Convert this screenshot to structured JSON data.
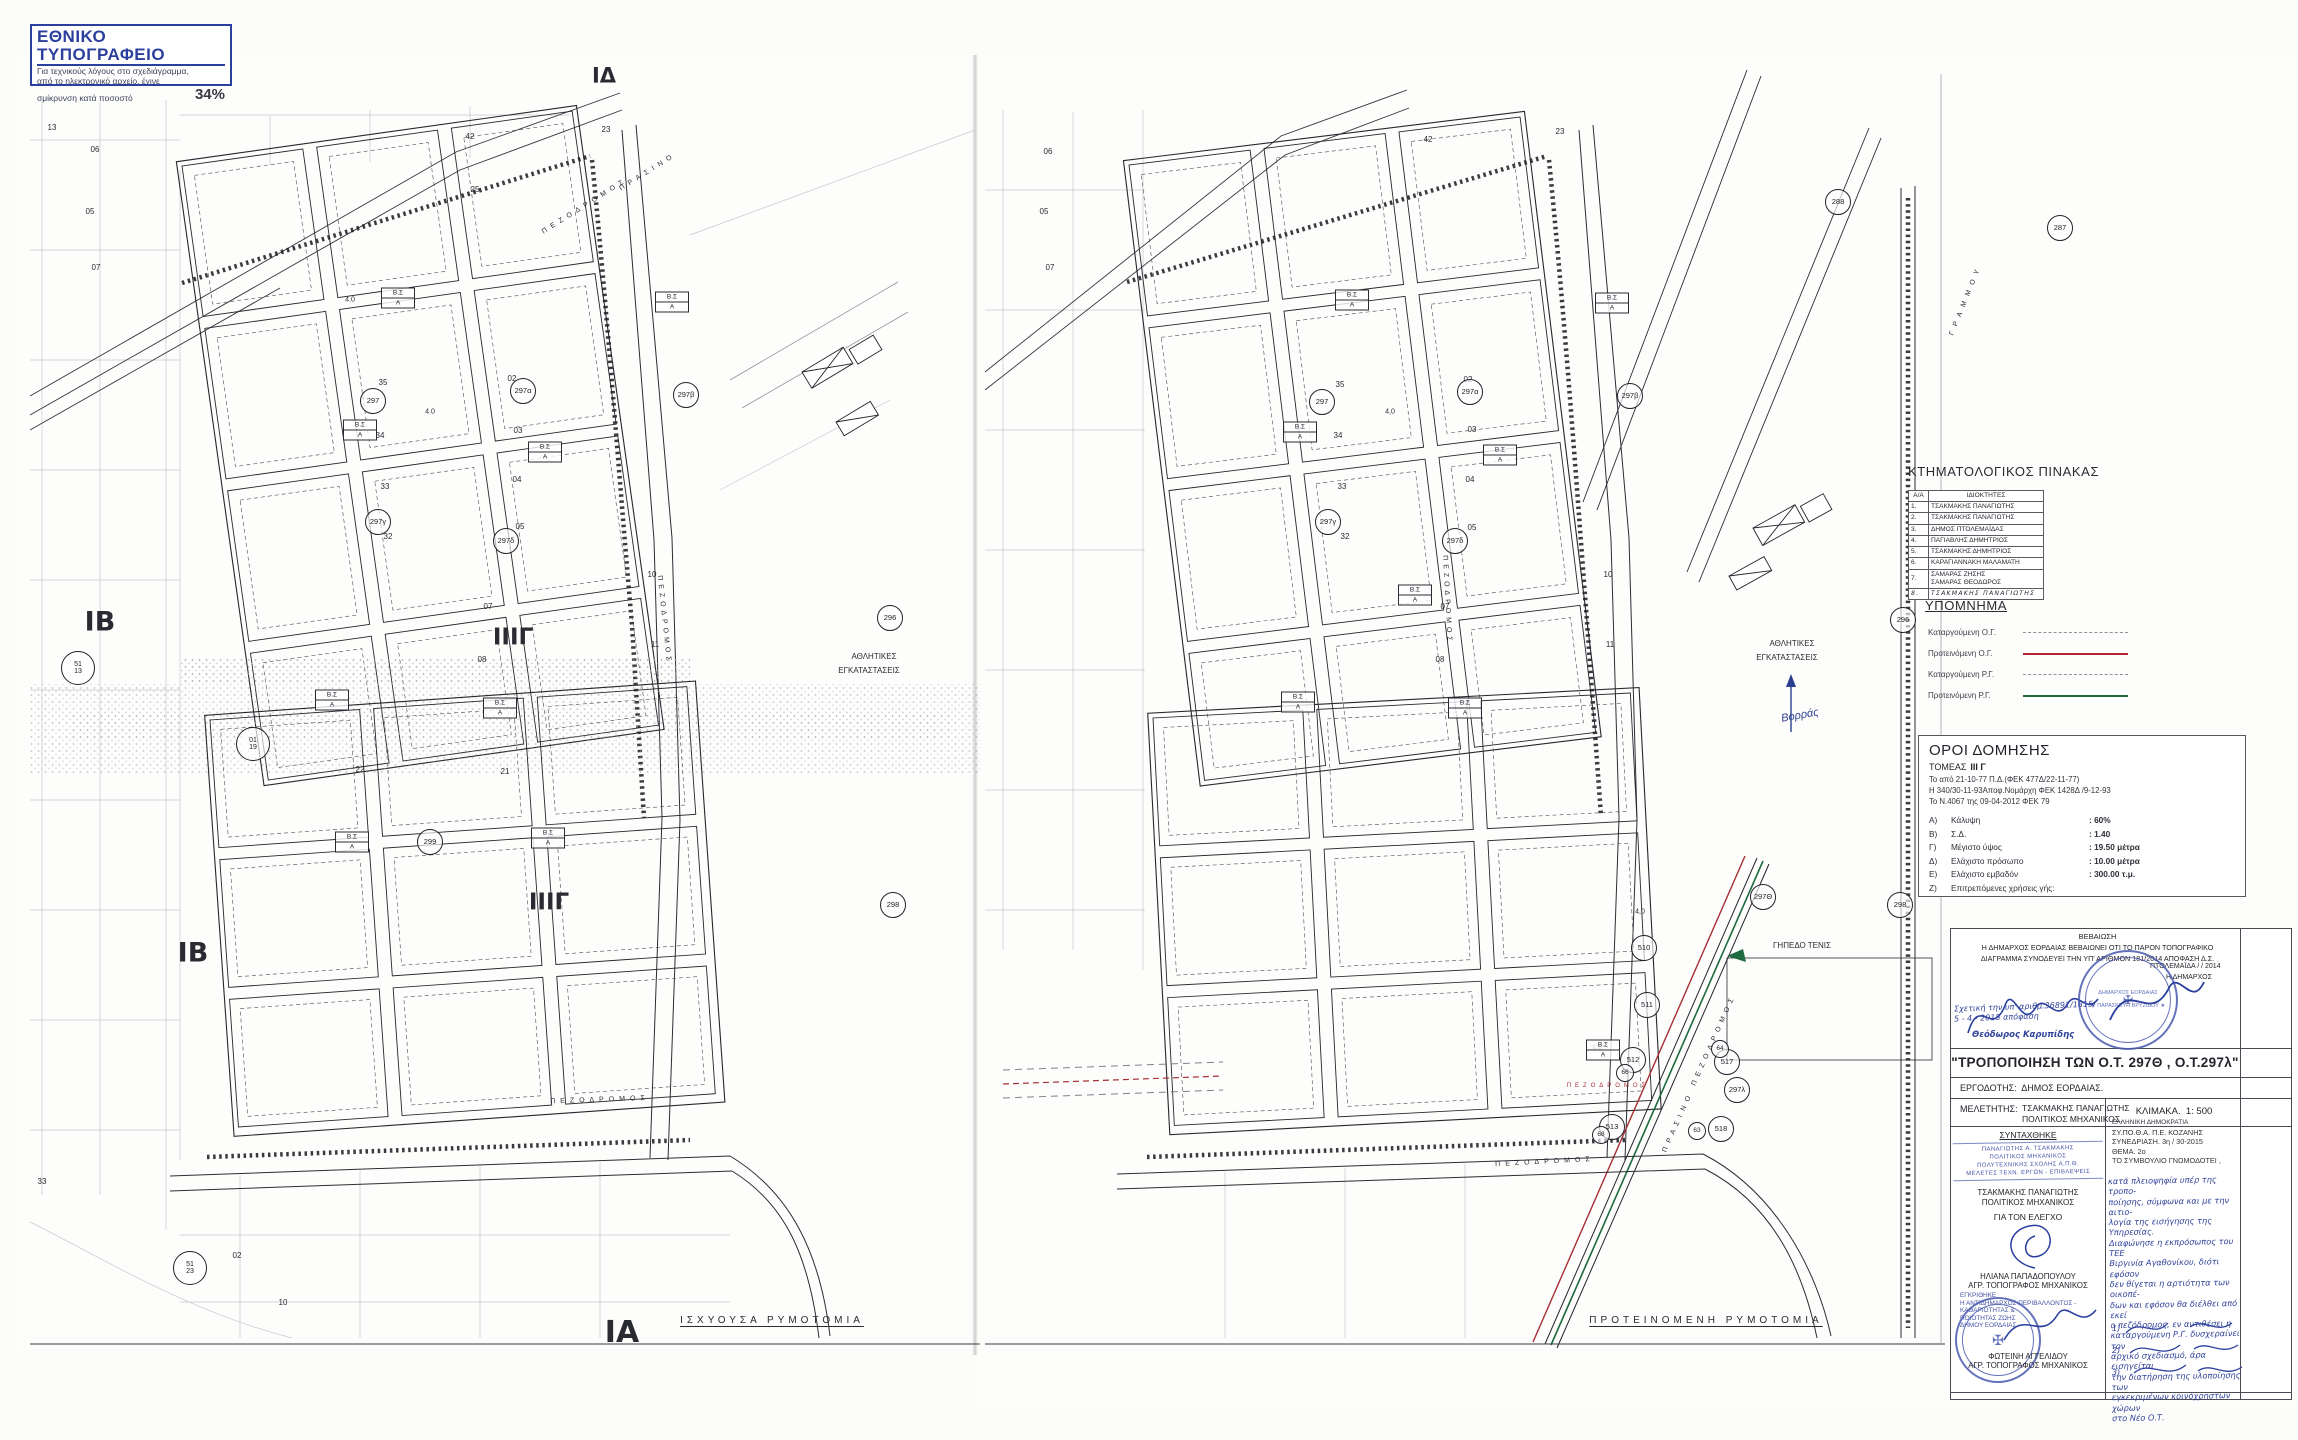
{
  "print_stamp": {
    "title": "ΕΘΝΙΚΟ ΤΥΠΟΓΡΑΦΕΙΟ",
    "line1": "Για τεχνικούς λόγους στο σχεδιάγραμμα,",
    "line2": "από το ηλεκτρονικό αρχείο, έγινε",
    "line3": "σμίκρυνση κατά ποσοστό",
    "percent": "34%"
  },
  "cadastral_table": {
    "title": "ΚΤΗΜΑΤΟΛΟΓΙΚΟΣ ΠΙΝΑΚΑΣ",
    "headers": [
      "Α/Α",
      "ΙΔΙΟΚΤΗΤΕΣ"
    ],
    "rows": [
      [
        "1.",
        "ΤΣΑΚΜΑΚΗΣ ΠΑΝΑΓΙΩΤΗΣ"
      ],
      [
        "2.",
        "ΤΣΑΚΜΑΚΗΣ ΠΑΝΑΓΙΩΤΗΣ"
      ],
      [
        "3.",
        "ΔΗΜΟΣ ΠΤΟΛΕΜΑΪΔΑΣ"
      ],
      [
        "4.",
        "ΠΑΓΙΑΒΛΗΣ ΔΗΜΗΤΡΙΟΣ"
      ],
      [
        "5.",
        "ΤΣΑΚΜΑΚΗΣ ΔΗΜΗΤΡΙΟΣ"
      ],
      [
        "6.",
        "ΚΑΡΑΓΙΑΝΝΑΚΗ ΜΑΛΑΜΑΤΗ"
      ],
      [
        "7.",
        "ΣΑΜΑΡΑΣ ΖΗΣΗΣ\nΣΑΜΑΡΑΣ ΘΕΟΔΩΡΟΣ"
      ],
      [
        "8.",
        "ΤΣΑΚΜΑΚΗΣ ΠΑΝΑΓΙΩΤΗΣ"
      ]
    ]
  },
  "legend": {
    "title": "ΥΠΟΜΝΗΜΑ",
    "items": [
      {
        "label": "Καταργούμενη Ο.Γ.",
        "line": "dashed",
        "color": "#8d929b"
      },
      {
        "label": "Προτεινόμενη Ο.Γ.",
        "line": "solid",
        "color": "#b2282e"
      },
      {
        "label": "Καταργούμενη Ρ.Γ.",
        "line": "dashed",
        "color": "#8d929b"
      },
      {
        "label": "Προτεινόμενη Ρ.Γ.",
        "line": "solid",
        "color": "#1e6b3c"
      }
    ]
  },
  "building_terms": {
    "title": "ΟΡΟΙ ΔΟΜΗΣΗΣ",
    "sector_label": "ΤΟΜΕΑΣ",
    "sector": "ΙΙΙ Γ",
    "refs": [
      "Το από 21-10-77 Π.Δ.(ΦΕΚ 477Δ/22-11-77)",
      "Η 340/30-11-93Αποφ.Νομάρχη ΦΕΚ 1428Δ /9-12-93",
      "Το Ν.4067 της 09-04-2012   ΦΕΚ 79"
    ],
    "items": [
      [
        "Α)",
        "Κάλυψη",
        ":  60%"
      ],
      [
        "Β)",
        "Σ.Δ.",
        ":   1.40"
      ],
      [
        "Γ)",
        "Μέγιστο  ύψος",
        ":  19.50 μέτρα"
      ],
      [
        "Δ)",
        "Ελάχιστο πρόσωπο",
        ":  10.00 μέτρα"
      ],
      [
        "Ε)",
        "Ελάχιστο εμβαδόν",
        ":  300.00 τ.μ."
      ],
      [
        "Ζ)",
        "Επιτρεπόμενες χρήσεις γής:",
        ""
      ]
    ]
  },
  "certification": {
    "title": "ΒΕΒΑΙΩΣΗ",
    "body1": "Η ΔΗΜΑΡΧΟΣ ΕΟΡΔΑΙΑΣ ΒΕΒΑΙΩΝΕΙ ΟΤΙ ΤΟ ΠΑΡΟΝ ΤΟΠΟΓΡΑΦΙΚΟ",
    "body2": "ΔΙΑΓΡΑΜΜΑ ΣΥΝΟΔΕΥΕΙ ΤΗΝ ΥΠ' ΑΡΙΘΜΟΝ 181/2014 ΑΠΟΦΑΣΗ Δ.Σ.",
    "handnote1": "Σχετική την υπ' αριθμ.36891/1815/",
    "handnote2": "5 - 4 - 2015  απόφαση",
    "signer": "Θεόδωρος Καρυπίδης",
    "place_date": "ΠΤΟΛΕΜΑΪΔΑ    /    / 2014",
    "mayor_label": "Η ΔΗΜΑΡΧΟΣ",
    "stamp_line1": "ΔΗΜΑΡΧΟΣ ΕΟΡΔΑΙΑΣ",
    "stamp_line2": "★ ΠΑΡΑΣΚΕΥΗ ΒΡΥΖΙΔΟΥ ★"
  },
  "project": {
    "title": "\"ΤΡΟΠΟΠΟΙΗΣΗ ΤΩΝ Ο.Τ. 297Θ , Ο.Τ.297λ\"",
    "client_label": "ΕΡΓΟΔΟΤΗΣ:",
    "client": "ΔΗΜΟΣ ΕΟΡΔΑΙΑΣ.",
    "designer_label": "ΜΕΛΕΤΗΤΗΣ:",
    "designer": "ΤΣΑΚΜΑΚΗΣ ΠΑΝΑΓΙΩΤΗΣ",
    "designer_role": "ΠΟΛΙΤΙΚΟΣ ΜΗΧΑΝΙΚΟΣ.",
    "scale_label": "ΚΛΙΜΑΚΑ.",
    "scale": "1: 500"
  },
  "signoff": {
    "drafted_header": "ΣΥΝΤΑΧΘΗΚΕ",
    "drafted_stamp": [
      "ΠΑΝΑΓΙΩΤΗΣ   Α.   ΤΣΑΚΜΑΚΗΣ",
      "ΠΟΛΙΤΙΚΟΣ  ΜΗΧΑΝΙΚΟΣ",
      "ΠΟΛΥΤΕΧΝΙΚΗΣ  ΣΧΟΛΗΣ  Α.Π.Θ.",
      "ΜΕΛΕΤΕΣ ΤΕΧΝ. ΕΡΓΩΝ - ΕΠΙΒΛΕΨΕΙΣ"
    ],
    "drafted_name": "ΤΣΑΚΜΑΚΗΣ ΠΑΝΑΓΙΩΤΗΣ",
    "drafted_role": "ΠΟΛΙΤΙΚΟΣ ΜΗΧΑΝΙΚΟΣ",
    "control_header": "ΓΙΑ ΤΟΝ ΕΛΕΓΧΟ",
    "control_name": "ΗΛΙΑΝΑ  ΠΑΠΑΔΟΠΟΥΛΟΥ",
    "control_role": "ΑΓΡ. ΤΟΠΟΓΡΑΦΟΣ ΜΗΧΑΝΙΚΟΣ",
    "approved_stamp": [
      "ΕΓΚΡΙΘΗΚΕ",
      "Η ΑΝΤΙΔΗΜΑΡΧΟΣ ΠΕΡΙΒΑΛΛΟΝΤΟΣ - ΚΑΘΑΡΙΟΤΗΤΑΣ &",
      "ΠΟΙΟΤΗΤΑΣ ΖΩΗΣ",
      "ΔΗΜΟΥ ΕΟΡΔΑΙΑΣ"
    ],
    "approved_name": "ΦΩΤΕΙΝΗ ΑΓΓΕΛΙΔΟΥ",
    "approved_role": "ΑΓΡ. ΤΟΠΟΓΡΑΦΟΣ ΜΗΧΑΝΙΚΟΣ"
  },
  "council": {
    "header_lines": [
      "ΕΛΛΗΝΙΚΗ ΔΗΜΟΚΡΑΤΙΑ",
      "ΣΥ.ΠΟ.Θ.Α.  Π.Ε.  ΚΟΖΑΝΗΣ",
      "ΣΥΝΕΔΡΙΑΣΗ.   3η / 30-2015",
      "ΘΕΜΑ.   2ο",
      "ΤΟ ΣΥΜΒΟΥΛΙΟ ΓΝΩΜΟΔΟΤΕΙ ,"
    ],
    "handnote": [
      "κατά πλειοψηφία υπέρ της τροπο-",
      "ποίησης, σύμφωνα και με την αιτιο-",
      "λογία της εισήγησης της Υπηρεσίας.",
      "Διαφώνησε η εκπρόσωπος του ΤΕΕ",
      "Βιργινία Αγαθονίκου, διότι εφόσον",
      "δεν θίγεται η αρτιότητα των οικοπέ-",
      "δων και εφόσον θα διέλθει από εκεί",
      "ο πεζόδρομος, εν αντιθέσει η",
      "καταργούμενη Ρ.Γ. δυσχεραίνει τον",
      "αρχικό σχεδιασμό, άρα εισηγείται",
      "την διατήρηση της υλοποίησης των",
      "εγκεκριμένων κοινόχρηστων χώρων",
      "στο  Νέο  Ο.Τ."
    ],
    "sig_marks": [
      "1)",
      "2)",
      "3)"
    ]
  },
  "map_symbols": {
    "bs_top": "Β.Σ",
    "bs_bottom": "Α"
  },
  "left_map": {
    "labels": [
      {
        "t": "ΙΒ",
        "x": 100,
        "y": 622,
        "s": 27,
        "b": 1
      },
      {
        "t": "ΙΒ",
        "x": 193,
        "y": 953,
        "s": 27,
        "b": 1
      },
      {
        "t": "ΙΙΙΓ",
        "x": 513,
        "y": 638,
        "s": 23,
        "b": 1
      },
      {
        "t": "ΙΙΙΓ",
        "x": 549,
        "y": 903,
        "s": 23,
        "b": 1
      },
      {
        "t": "ΙΑ",
        "x": 622,
        "y": 1333,
        "s": 30,
        "b": 1
      },
      {
        "t": "ΙΔ",
        "x": 604,
        "y": 76,
        "s": 21,
        "b": 1
      },
      {
        "t": "ΙΣΧΥΟΥΣΑ ΡΥΜΟΤΟΜΙΑ",
        "x": 772,
        "y": 1321,
        "s": 10,
        "ls": 4,
        "u": 1
      },
      {
        "t": "ΑΘΛΗΤΙΚΕΣ",
        "x": 874,
        "y": 657,
        "s": 8
      },
      {
        "t": "ΕΓΚΑΤΑΣΤΑΣΕΙΣ",
        "x": 869,
        "y": 671,
        "s": 8
      },
      {
        "t": "ΠΕΖΟΔΡΟΜΟΣ",
        "x": 585,
        "y": 206,
        "s": 7,
        "ls": 5,
        "r": -32
      },
      {
        "t": "ΠΡΑΣΙΝΟ",
        "x": 648,
        "y": 172,
        "s": 7,
        "ls": 5,
        "r": -32
      },
      {
        "t": "ΠΕΖΟΔΡΟΜΟΣ",
        "x": 664,
        "y": 620,
        "s": 7,
        "ls": 4,
        "r": 84
      },
      {
        "t": "ΠΕΖΟΔΡΟΜΟΣ",
        "x": 600,
        "y": 1100,
        "s": 7,
        "ls": 5,
        "r": -2
      },
      {
        "t": "42",
        "x": 470,
        "y": 137,
        "s": 8
      },
      {
        "t": "23",
        "x": 606,
        "y": 130,
        "s": 8
      },
      {
        "t": "25",
        "x": 475,
        "y": 190,
        "s": 8
      },
      {
        "t": "35",
        "x": 383,
        "y": 383,
        "s": 8
      },
      {
        "t": "34",
        "x": 380,
        "y": 436,
        "s": 8
      },
      {
        "t": "33",
        "x": 385,
        "y": 487,
        "s": 8
      },
      {
        "t": "32",
        "x": 388,
        "y": 537,
        "s": 8
      },
      {
        "t": "02",
        "x": 512,
        "y": 379,
        "s": 8
      },
      {
        "t": "03",
        "x": 518,
        "y": 431,
        "s": 8
      },
      {
        "t": "04",
        "x": 517,
        "y": 480,
        "s": 8
      },
      {
        "t": "05",
        "x": 520,
        "y": 527,
        "s": 8
      },
      {
        "t": "07",
        "x": 488,
        "y": 607,
        "s": 8
      },
      {
        "t": "08",
        "x": 482,
        "y": 660,
        "s": 8
      },
      {
        "t": "10",
        "x": 652,
        "y": 575,
        "s": 8
      },
      {
        "t": "11",
        "x": 655,
        "y": 645,
        "s": 8
      },
      {
        "t": "4.0",
        "x": 430,
        "y": 412,
        "s": 7
      },
      {
        "t": "4.0",
        "x": 350,
        "y": 300,
        "s": 7
      },
      {
        "t": "06",
        "x": 95,
        "y": 150,
        "s": 8
      },
      {
        "t": "05",
        "x": 90,
        "y": 212,
        "s": 8
      },
      {
        "t": "07",
        "x": 96,
        "y": 268,
        "s": 8
      },
      {
        "t": "13",
        "x": 52,
        "y": 128,
        "s": 8
      },
      {
        "t": "33",
        "x": 42,
        "y": 1182,
        "s": 8
      },
      {
        "t": "02",
        "x": 237,
        "y": 1256,
        "s": 8
      },
      {
        "t": "10",
        "x": 283,
        "y": 1303,
        "s": 8
      },
      {
        "t": "21",
        "x": 505,
        "y": 772,
        "s": 8
      },
      {
        "t": "22",
        "x": 360,
        "y": 770,
        "s": 8
      }
    ],
    "circles": [
      {
        "t": "297",
        "x": 373,
        "y": 401
      },
      {
        "t": "297α",
        "x": 523,
        "y": 391
      },
      {
        "t": "297β",
        "x": 686,
        "y": 395
      },
      {
        "t": "297γ",
        "x": 378,
        "y": 522
      },
      {
        "t": "297δ",
        "x": 506,
        "y": 541
      },
      {
        "t": "296",
        "x": 890,
        "y": 618
      },
      {
        "t": "298",
        "x": 893,
        "y": 905
      },
      {
        "t": "299",
        "x": 430,
        "y": 842
      },
      {
        "t": "01\n19",
        "x": 253,
        "y": 744,
        "d": 32
      },
      {
        "t": "51\n13",
        "x": 78,
        "y": 668,
        "d": 32
      },
      {
        "t": "51\n23",
        "x": 190,
        "y": 1268,
        "d": 32
      }
    ],
    "bs": [
      {
        "x": 398,
        "y": 298
      },
      {
        "x": 672,
        "y": 302
      },
      {
        "x": 360,
        "y": 430
      },
      {
        "x": 545,
        "y": 452
      },
      {
        "x": 332,
        "y": 700
      },
      {
        "x": 500,
        "y": 708
      },
      {
        "x": 352,
        "y": 842
      },
      {
        "x": 548,
        "y": 838
      }
    ]
  },
  "right_map": {
    "labels": [
      {
        "t": "ΠΡΟΤΕΙΝΟΜΕΝΗ ΡΥΜΟΤΟΜΙΑ",
        "x": 1706,
        "y": 1321,
        "s": 10,
        "ls": 4,
        "u": 1
      },
      {
        "t": "ΑΘΛΗΤΙΚΕΣ",
        "x": 1792,
        "y": 644,
        "s": 8
      },
      {
        "t": "ΕΓΚΑΤΑΣΤΑΣΕΙΣ",
        "x": 1787,
        "y": 658,
        "s": 8
      },
      {
        "t": "ΓΗΠΕΔΟ ΤΕΝΙΣ",
        "x": 1802,
        "y": 946,
        "s": 8
      },
      {
        "t": "Βορράς",
        "x": 1800,
        "y": 716,
        "s": 11,
        "i": 1,
        "c": "#2c3f8f",
        "r": -10
      },
      {
        "t": "ΓΡΑΜΜΟΥ",
        "x": 1966,
        "y": 300,
        "s": 7,
        "ls": 6,
        "r": -68
      },
      {
        "t": "ΠΕΖΟΔΡΟΜΟΣ",
        "x": 1714,
        "y": 1040,
        "s": 7,
        "ls": 5,
        "r": -66
      },
      {
        "t": "ΠΡΑΣΙΝΟ",
        "x": 1678,
        "y": 1122,
        "s": 7,
        "ls": 5,
        "r": -66
      },
      {
        "t": "ΠΕΖΟΔΡΟΜΟΣ",
        "x": 1608,
        "y": 1086,
        "s": 6,
        "ls": 4,
        "c": "#a62f35"
      },
      {
        "t": "ΠΕΖΟΔΡΟΜΟΣ",
        "x": 1447,
        "y": 600,
        "s": 7,
        "ls": 4,
        "r": 87
      },
      {
        "t": "ΠΕΖΟΔΡΟΜΟΣ",
        "x": 1545,
        "y": 1162,
        "s": 7,
        "ls": 5,
        "r": -3
      },
      {
        "t": "42",
        "x": 1428,
        "y": 140,
        "s": 8
      },
      {
        "t": "23",
        "x": 1560,
        "y": 132,
        "s": 8
      },
      {
        "t": "02",
        "x": 1468,
        "y": 380,
        "s": 8
      },
      {
        "t": "03",
        "x": 1472,
        "y": 430,
        "s": 8
      },
      {
        "t": "04",
        "x": 1470,
        "y": 480,
        "s": 8
      },
      {
        "t": "05",
        "x": 1472,
        "y": 528,
        "s": 8
      },
      {
        "t": "10",
        "x": 1608,
        "y": 575,
        "s": 8
      },
      {
        "t": "11",
        "x": 1610,
        "y": 645,
        "s": 8
      },
      {
        "t": "07",
        "x": 1445,
        "y": 607,
        "s": 8
      },
      {
        "t": "08",
        "x": 1440,
        "y": 660,
        "s": 8
      },
      {
        "t": "32",
        "x": 1345,
        "y": 537,
        "s": 8
      },
      {
        "t": "33",
        "x": 1342,
        "y": 487,
        "s": 8
      },
      {
        "t": "34",
        "x": 1338,
        "y": 436,
        "s": 8
      },
      {
        "t": "35",
        "x": 1340,
        "y": 385,
        "s": 8
      },
      {
        "t": "4,0",
        "x": 1390,
        "y": 412,
        "s": 7
      },
      {
        "t": "4,0",
        "x": 1597,
        "y": 1048,
        "s": 7
      },
      {
        "t": "4,0",
        "x": 1640,
        "y": 912,
        "s": 7
      },
      {
        "t": "06",
        "x": 1048,
        "y": 152,
        "s": 8
      },
      {
        "t": "05",
        "x": 1044,
        "y": 212,
        "s": 8
      },
      {
        "t": "07",
        "x": 1050,
        "y": 268,
        "s": 8
      }
    ],
    "circles": [
      {
        "t": "288",
        "x": 1838,
        "y": 202
      },
      {
        "t": "287",
        "x": 2060,
        "y": 228
      },
      {
        "t": "297",
        "x": 1322,
        "y": 402
      },
      {
        "t": "297α",
        "x": 1470,
        "y": 392
      },
      {
        "t": "297β",
        "x": 1630,
        "y": 396
      },
      {
        "t": "297γ",
        "x": 1328,
        "y": 522
      },
      {
        "t": "297δ",
        "x": 1455,
        "y": 541
      },
      {
        "t": "297Θ",
        "x": 1763,
        "y": 897
      },
      {
        "t": "510",
        "x": 1644,
        "y": 948
      },
      {
        "t": "511",
        "x": 1647,
        "y": 1005
      },
      {
        "t": "512",
        "x": 1633,
        "y": 1060
      },
      {
        "t": "513",
        "x": 1612,
        "y": 1127
      },
      {
        "t": "517",
        "x": 1727,
        "y": 1062
      },
      {
        "t": "518",
        "x": 1721,
        "y": 1129
      },
      {
        "t": "297λ",
        "x": 1737,
        "y": 1090
      },
      {
        "t": "63",
        "x": 1697,
        "y": 1131,
        "d": 16
      },
      {
        "t": "64",
        "x": 1720,
        "y": 1049,
        "d": 16
      },
      {
        "t": "66",
        "x": 1625,
        "y": 1073,
        "d": 16
      },
      {
        "t": "68",
        "x": 1601,
        "y": 1135,
        "d": 16
      },
      {
        "t": "296",
        "x": 1903,
        "y": 620
      },
      {
        "t": "298",
        "x": 1900,
        "y": 905
      }
    ],
    "bs": [
      {
        "x": 1352,
        "y": 300
      },
      {
        "x": 1612,
        "y": 303
      },
      {
        "x": 1300,
        "y": 432
      },
      {
        "x": 1500,
        "y": 455
      },
      {
        "x": 1415,
        "y": 595
      },
      {
        "x": 1298,
        "y": 702
      },
      {
        "x": 1465,
        "y": 708
      },
      {
        "x": 1603,
        "y": 1050
      }
    ]
  }
}
